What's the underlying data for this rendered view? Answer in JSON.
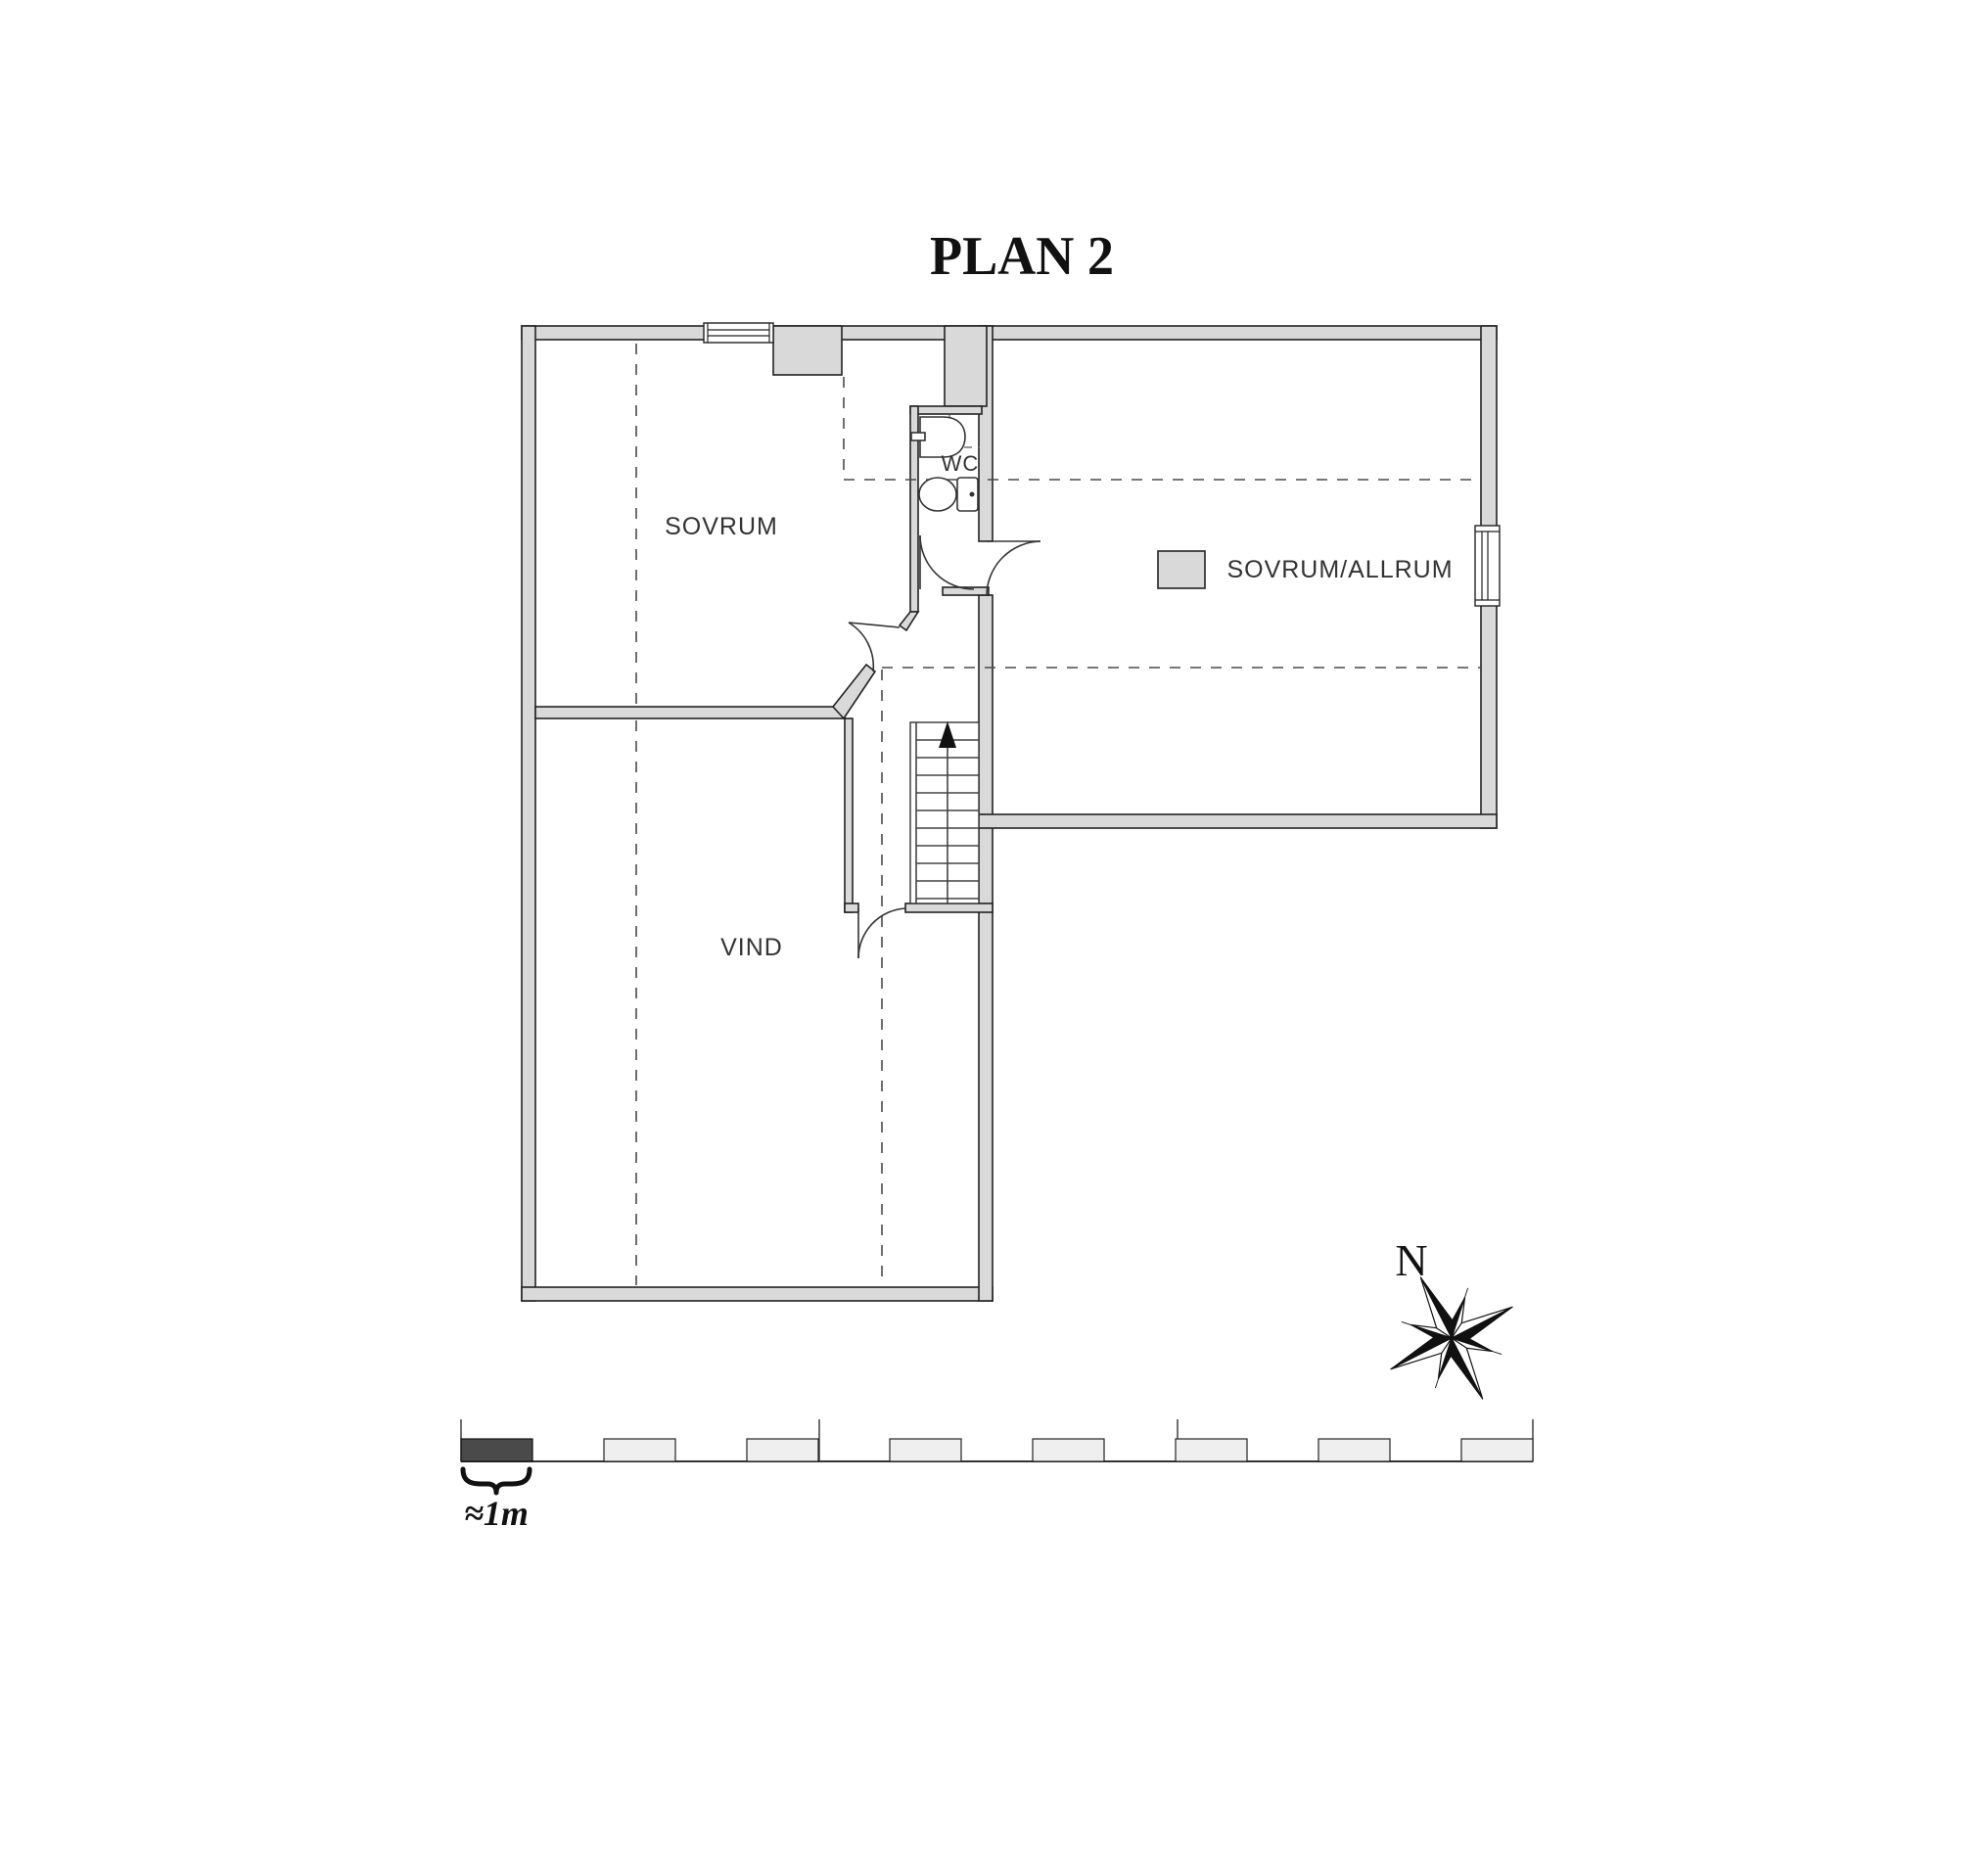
{
  "title": "PLAN 2",
  "rooms": {
    "sovrum": "SOVRUM",
    "wc": "WC",
    "sovrum_allrum": "SOVRUM/ALLRUM",
    "vind": "VIND"
  },
  "compass": {
    "north_label": "N"
  },
  "scale_bar": {
    "label": "≈1m",
    "segments_total": 8,
    "meters_per_segment": 1
  },
  "colors": {
    "wall_fill": "#d9d9d9",
    "wall_stroke": "#222222",
    "dashed_line": "#4a4a4a",
    "label_text": "#333333",
    "scale_dark_box": "#4a4a4a",
    "scale_light_box": "#efefef",
    "arrow_black": "#111111"
  }
}
